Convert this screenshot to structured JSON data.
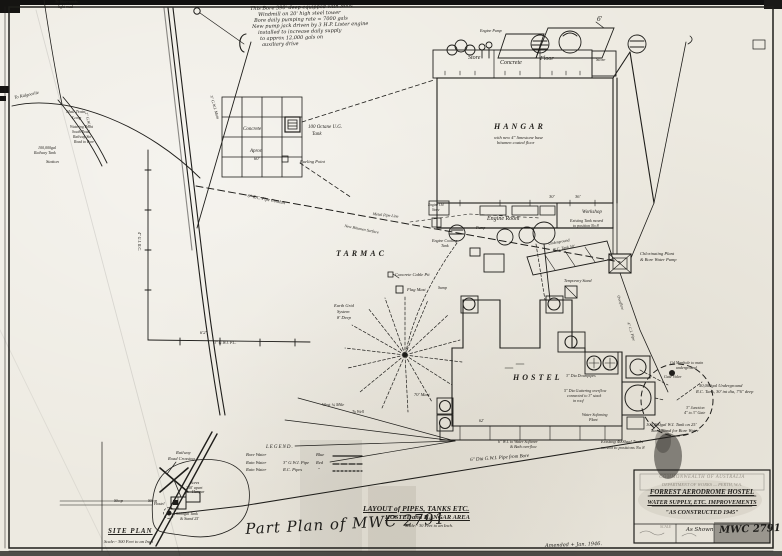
{
  "note": {
    "lines": [
      "This Bore 390' deep equipped with Mills",
      "Windmill on 20' high steel tower",
      "Bore daily pumping rate = 7000 gals",
      "New pump jack driven by 3 H.P. Lister engine",
      "installed to increase daily supply",
      "to approx 12,000 gals on",
      "auxiliary drive"
    ]
  },
  "labels": {
    "to_waterworks1": "To Waterworks",
    "to_waterworks2": "light road",
    "to_kalgoorlie": "To Kalgoorlie",
    "mail_loop1": "Mail Train",
    "mail_loop2": "Loop",
    "watering_point": "Watering Point",
    "south_road": "South Road",
    "railway_stn": "Railway Stn",
    "road_to_bore": "Road to Bore",
    "railway_tank1": "100,000gal",
    "railway_tank2": "Railway Tank",
    "station": "Station",
    "gwi_main": "3\" G.W.I. Main",
    "gwi_left": "2\" G.W.I.",
    "gi_rc": "4\" G.I. R.C.",
    "rc_conduit": "6\" R.C. Pipe Conduit",
    "metal_pipe": "Metal Pipe Line",
    "bitumen": "New Bitumen Surface",
    "tarmac": "TARMAC",
    "apron_concrete": "Concrete",
    "apron_word": "Apron",
    "apron_dim": "60'",
    "octane1": "100 Octane U.G.",
    "octane2": "Tank",
    "fueling": "Fueling Point",
    "hangar": "HANGAR",
    "hangar_note1": "with new 4\" limestone base",
    "hangar_note2": "bitumen coated floor",
    "store_left": "Store",
    "concrete_word": "Concrete",
    "floor_word": "Floor",
    "store_right": "Store",
    "engine_pump": "Engine Pump",
    "six_ft": "6'",
    "engine_room": "Engine Room",
    "workshop": "Workshop",
    "exist_tank1": "Existing Tank moved",
    "exist_tank2": "to position No 8",
    "dim_30": "30'",
    "dim_36": "36'",
    "engine_oil1": "Engine Oil",
    "engine_oil2": "Store",
    "cooling1": "Engine Cooling",
    "cooling2": "Tank",
    "pump1": "Pump",
    "sump": "Sump",
    "ug_rc1": "Underground",
    "ug_rc2": "R.C. Tank 50'",
    "temp_stand": "Temporary Stand",
    "chlor1": "Chlorinating Plant",
    "chlor2": "& Bore Water Pump",
    "overflow": "Overflow",
    "ci_pipe": "4\" C.I. Pipe",
    "hostel": "HOSTEL",
    "downpipes": "3\" Dia Downpipes",
    "gutter1": "5\" Dia Guttering overflow",
    "gutter2": "connected to 3\" stack",
    "gutter3": "in roof",
    "softplant1": "Water Softening",
    "softplant2": "Plant",
    "earth1": "Earth Grid",
    "earth2": "System",
    "earth3": "8' Deep",
    "flag_mast": "Flag Mast",
    "cable_pit": "Concrete Cable Pit",
    "west_mile": "West ¼ Mile",
    "to_well": "To Well",
    "mast70": "70' Mast",
    "dim_62a": "6'2\"",
    "gwi_pc": "3\" G.W.I. P.C.",
    "dim_62b": "62'",
    "pipe_bore": "6\" Dia G.W.I. Pipe from Bore",
    "softener1": "6\" W.I. to Water Softener",
    "softener2": "& Bath overflow",
    "manhole1": "Gd Manhole to main",
    "manhole2": "underground",
    "gate_valve": "Gate Valve",
    "ug_tank1": "50,000gal Underground",
    "ug_tank2": "R.C. Tank, 30' int dia, 7'6\" deep",
    "junction1": "3\" Junction",
    "junction2": "4\" to 3\" Gate",
    "stand1": "100,000gal W.I. Tank on 25'",
    "stand2": "Steel Stand for Bore Water",
    "exist4000a": "Existing 4000gal Tanks",
    "exist4000b": "moved to positions No 8",
    "shop1": "Shop",
    "shop2": "Shop",
    "crossing1": "Railway",
    "crossing2": "Road Crossing",
    "sp_hangar": "Hangar",
    "sp_hostel": "Hostel",
    "bores1": "Bores",
    "bores2": "300' apart",
    "tank5000a": "5000gal Tank",
    "tank5000b": "& Stand 25'"
  },
  "legend": {
    "title": "LEGEND.",
    "rows": [
      {
        "item": "Bore Water",
        "spec": "",
        "colour": "Blue"
      },
      {
        "item": "Rain Water",
        "spec": "3\" G.W.I. Pipe",
        "colour": "Red"
      },
      {
        "item": "Rain Water",
        "spec": "R.C. Pipes",
        "colour": "\""
      }
    ]
  },
  "captions": {
    "layout_title": "LAYOUT of PIPES, TANKS ETC.",
    "layout_subtitle": "HOSTEL and HANGAR AREA",
    "layout_scale": "Scale:- 30 Feet to an Inch.",
    "site_plan_title": "SITE PLAN",
    "site_plan_scale": "Scale:- 300 Feet to an Inch",
    "part_plan_note": "Part Plan of MWC 2791",
    "amended_note": "Amended + Jan. 1946."
  },
  "title_block": {
    "letterhead1": "COMMONWEALTH OF AUSTRALIA",
    "letterhead2": "DEPARTMENT OF WORKS — PERTH, W.A.",
    "title1": "FORREST AERODROME HOSTEL",
    "title2": "WATER SUPPLY, ETC. IMPROVEMENTS",
    "title3": "\"AS CONSTRUCTED 1945\"",
    "scale_label": "SCALE",
    "scale_value": "As Shown",
    "drawing_number": "MWC 2791"
  }
}
